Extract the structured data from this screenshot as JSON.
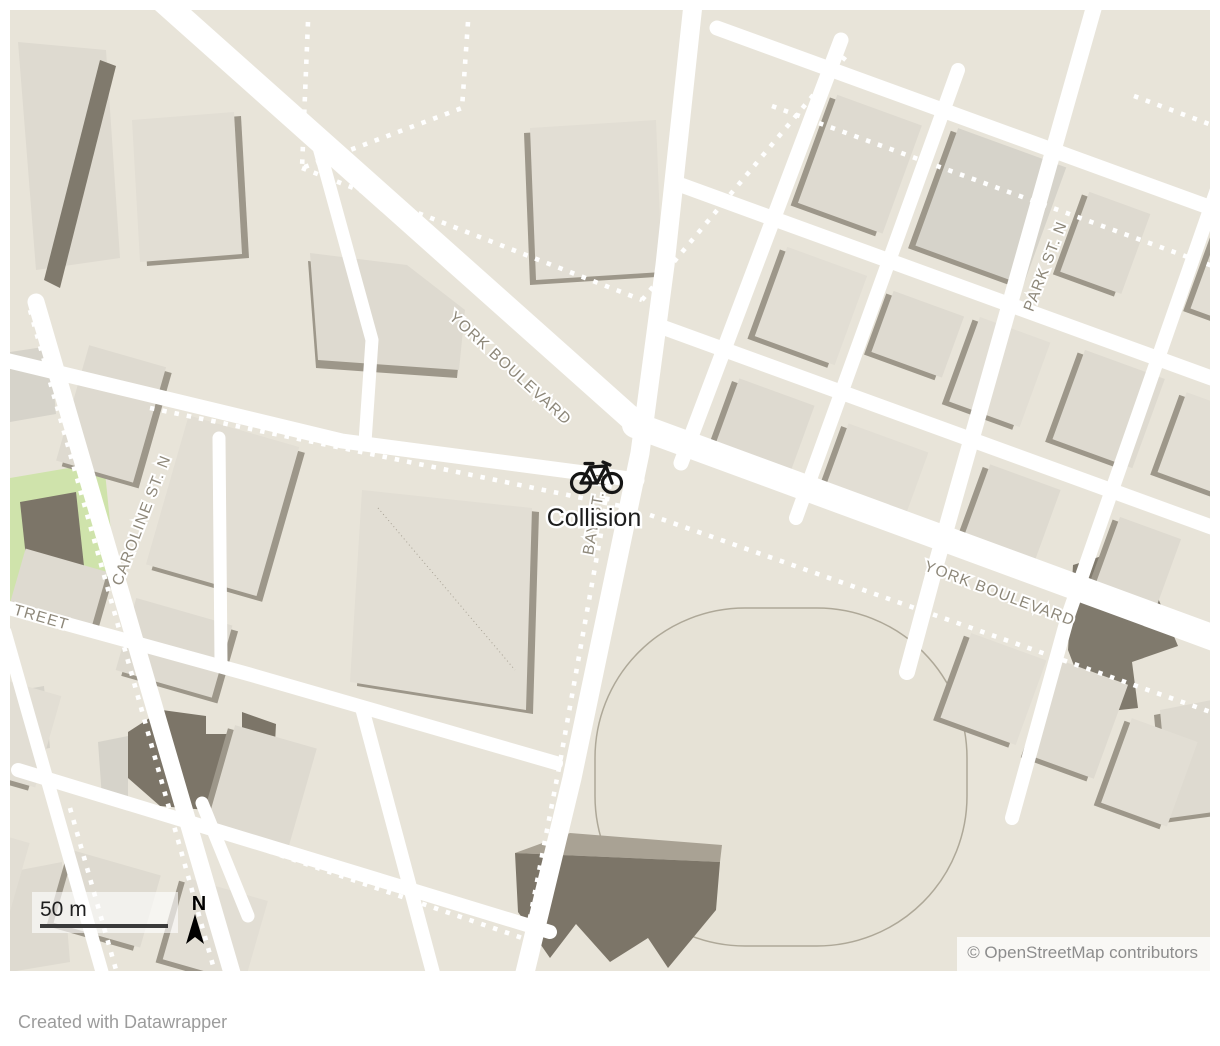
{
  "map": {
    "marker": {
      "label": "Collision",
      "icon": "bicycle-icon"
    },
    "street_labels": {
      "york_upper": "YORK BOULEVARD",
      "york_lower": "YORK BOULEVARD",
      "caroline": "CAROLINE ST. N",
      "bay": "BAY ST. N",
      "park": "PARK ST. N",
      "street_partial": "TREET"
    },
    "controls": {
      "scale_label": "50 m",
      "north_label": "N"
    },
    "attribution": "© OpenStreetMap contributors",
    "colors": {
      "land": "#e8e4d9",
      "road": "#ffffff",
      "building_light": "#dedad0",
      "building_mid": "#e2ded4",
      "building_gray": "#d6d3ca",
      "building_shadow": "#9d978a",
      "building_dark": "#7c7568",
      "park_green": "#cfe3ab",
      "street_label": "#8d8779",
      "marker_text": "#1d1d1d",
      "scale_bar": "#3a3a3a",
      "attribution_text": "#8d8d8d",
      "footer_text": "#9c9c9c"
    }
  },
  "footer": {
    "credit": "Created with Datawrapper"
  }
}
